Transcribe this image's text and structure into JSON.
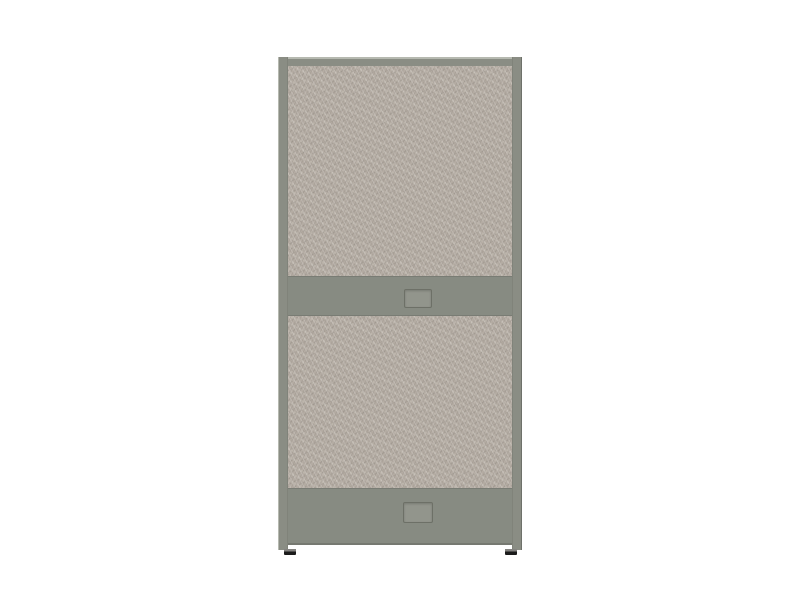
{
  "scene": {
    "description": "3D product render of a freestanding two-tier fabric office partition panel on a plain white background",
    "background_color": "#ffffff"
  },
  "product": {
    "name": "office-partition-panel",
    "parts": [
      "top-frame-rail",
      "left-frame-post",
      "right-frame-post",
      "upper-fabric-panel",
      "middle-rail",
      "middle-rail-grommet-plate",
      "lower-fabric-panel",
      "kick-band",
      "kick-band-grommet-plate",
      "left-glide-foot",
      "right-glide-foot"
    ],
    "colors": {
      "background": "#ffffff",
      "frame": "#8a8d84",
      "frame_highlight": "#b6b9b0",
      "frame_shadow": "#6e716a",
      "rail": "#878b82",
      "fabric_base": "#b4aca3",
      "fabric_fleck_light": "#cdc7be",
      "fabric_fleck_dark": "#948d85",
      "grommet_fill": "#92958c",
      "grommet_outline": "#6d7067",
      "foot_dark": "#1b1b1b",
      "foot_light": "#83827f"
    }
  }
}
